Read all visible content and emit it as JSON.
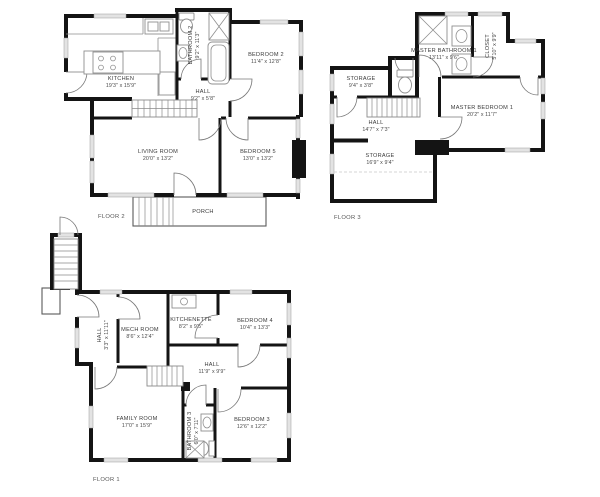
{
  "floors": {
    "floor2": {
      "label": "FLOOR 2",
      "rooms": {
        "kitchen": {
          "name": "KITCHEN",
          "dims": "19'3\" x 15'9\""
        },
        "bathroom2": {
          "name": "BATHROOM 2",
          "dims": "9'2\" x 11'3\""
        },
        "hall": {
          "name": "HALL",
          "dims": "9'2\" x 5'8\""
        },
        "bedroom2": {
          "name": "BEDROOM 2",
          "dims": "11'4\" x 12'8\""
        },
        "living_room": {
          "name": "LIVING ROOM",
          "dims": "20'0\" x 13'2\""
        },
        "bedroom5": {
          "name": "BEDROOM 5",
          "dims": "13'0\" x 13'2\""
        },
        "porch": {
          "name": "PORCH"
        }
      }
    },
    "floor3": {
      "label": "FLOOR 3",
      "rooms": {
        "master_bathroom1": {
          "name": "MASTER BATHROOM 1",
          "dims": "13'11\" x 9'6\""
        },
        "closet": {
          "name": "CLOSET",
          "dims": "5'10\" x 9'9\""
        },
        "storage_upper": {
          "name": "STORAGE",
          "dims": "9'4\" x 3'8\""
        },
        "hall": {
          "name": "HALL",
          "dims": "14'7\" x 7'3\""
        },
        "master_bedroom1": {
          "name": "MASTER BEDROOM 1",
          "dims": "20'2\" x 11'7\""
        },
        "storage_lower": {
          "name": "STORAGE",
          "dims": "16'9\" x 9'4\""
        }
      }
    },
    "floor1": {
      "label": "FLOOR 1",
      "rooms": {
        "hall_side": {
          "name": "HALL",
          "dims": "3'3\" x 11'11\""
        },
        "mech_room": {
          "name": "MECH ROOM",
          "dims": "8'6\" x 12'4\""
        },
        "kitchenette": {
          "name": "KITCHENETTE",
          "dims": "8'2\" x 9'5\""
        },
        "bedroom4": {
          "name": "BEDROOM 4",
          "dims": "10'4\" x 13'3\""
        },
        "hall_center": {
          "name": "HALL",
          "dims": "11'9\" x 9'9\""
        },
        "family_room": {
          "name": "FAMILY ROOM",
          "dims": "17'0\" x 15'9\""
        },
        "bathroom3": {
          "name": "BATHROOM 3",
          "dims": "6'0\" x 7'11\""
        },
        "bedroom3": {
          "name": "BEDROOM 3",
          "dims": "12'6\" x 12'2\""
        }
      }
    }
  },
  "colors": {
    "background": "#ffffff",
    "wall": "#141414",
    "window_fill": "#e3e3e3",
    "fixture_stroke": "#8f8f8f",
    "label_text": "#3b3b3b",
    "floor_label_text": "#555555"
  }
}
